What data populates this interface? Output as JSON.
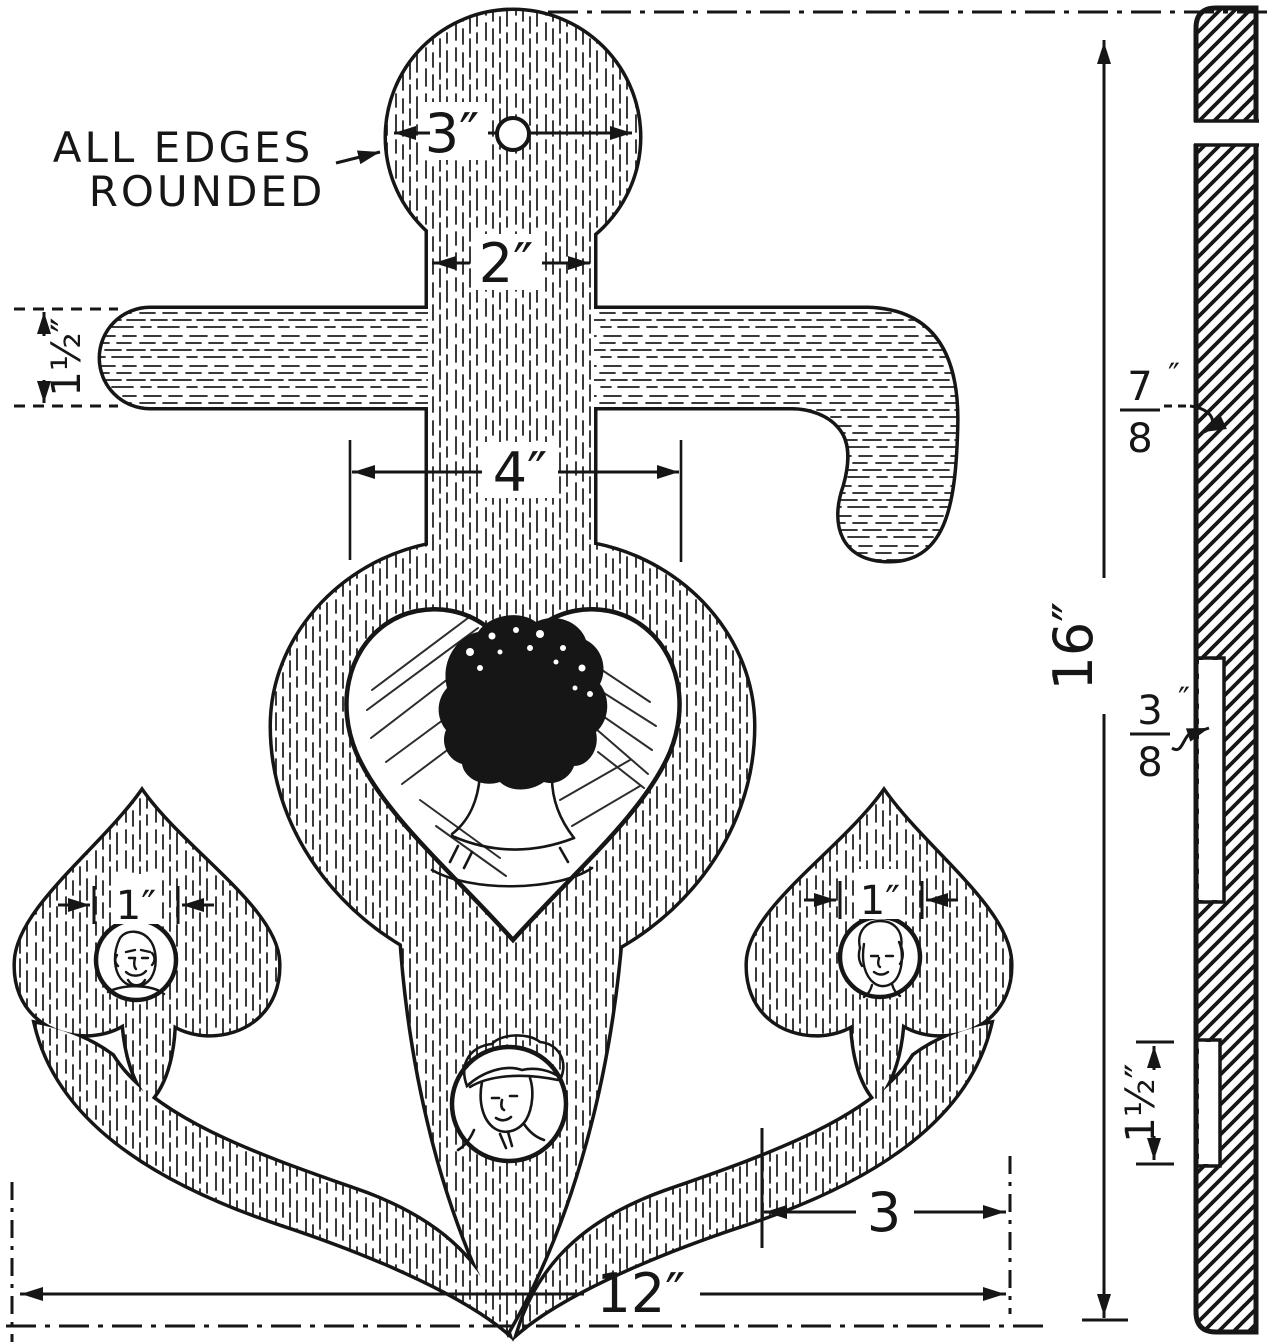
{
  "canvas": {
    "ink": "#161616",
    "paper": "#ffffff"
  },
  "note": {
    "line1": "ALL EDGES",
    "line2": "ROUNDED"
  },
  "front_view": {
    "dim_head_diameter": "3″",
    "dim_shank_width": "2″",
    "dim_body_width": "4″",
    "dim_arm_width": "1½″",
    "dim_left_hole_diameter": "1″",
    "dim_right_hole_diameter": "1″",
    "dim_fluke_to_edge": "3",
    "dim_overall_width": "12″",
    "dim_overall_height": "16″"
  },
  "side_view": {
    "dim_thickness": {
      "numerator": "7",
      "denominator": "8",
      "unit": "″"
    },
    "dim_recess_depth": {
      "numerator": "3",
      "denominator": "8",
      "unit": "″"
    },
    "dim_recess_length": "1½″"
  }
}
